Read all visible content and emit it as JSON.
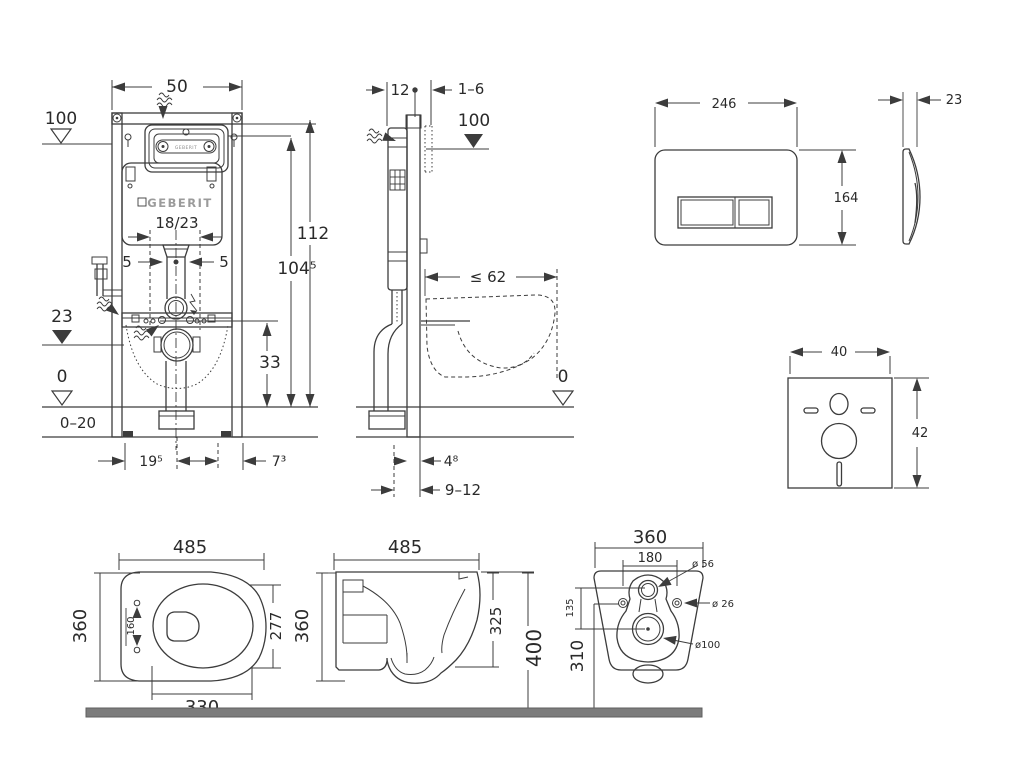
{
  "colors": {
    "line": "#3c3c3c",
    "text": "#2a2a2a",
    "logo_gray": "#9b9b9b",
    "floor_bar": "#7c7c7c"
  },
  "frame_front": {
    "width": "50",
    "level_top": "100",
    "height_total": "112",
    "height_fixing": "104⁵",
    "brand": "GEBERIT",
    "window_brand": "GEBERIT",
    "cistern_model": "18/23",
    "offset_left": "5",
    "offset_right": "5",
    "level_inlet": "23",
    "height_drain": "33",
    "level_floor": "0",
    "floor_range": "0–20",
    "dim_bottom_left": "19⁵",
    "dim_bottom_right": "7³"
  },
  "frame_side": {
    "depth": "12",
    "wall_gap": "1–6",
    "level_top": "100",
    "max_depth": "≤ 62",
    "level_floor": "0",
    "dim_front": "4⁸",
    "dim_floor": "9–12"
  },
  "flush_plate": {
    "width": "246",
    "height": "164",
    "depth": "23"
  },
  "sound_pad": {
    "width": "40",
    "height": "42"
  },
  "wc_top": {
    "length": "485",
    "width": "360",
    "seat_depth": "277",
    "hinge_spacing": "160",
    "cutout_length": "330"
  },
  "wc_side": {
    "length": "485",
    "height": "360",
    "body_height": "325",
    "total_height": "400"
  },
  "wc_rear": {
    "width": "360",
    "hole_spacing": "180",
    "dia_flush": "ø 56",
    "dia_fixing": "ø 26",
    "offset_flush_drain": "135",
    "height_fixing": "310",
    "dia_drain": "ø100"
  }
}
